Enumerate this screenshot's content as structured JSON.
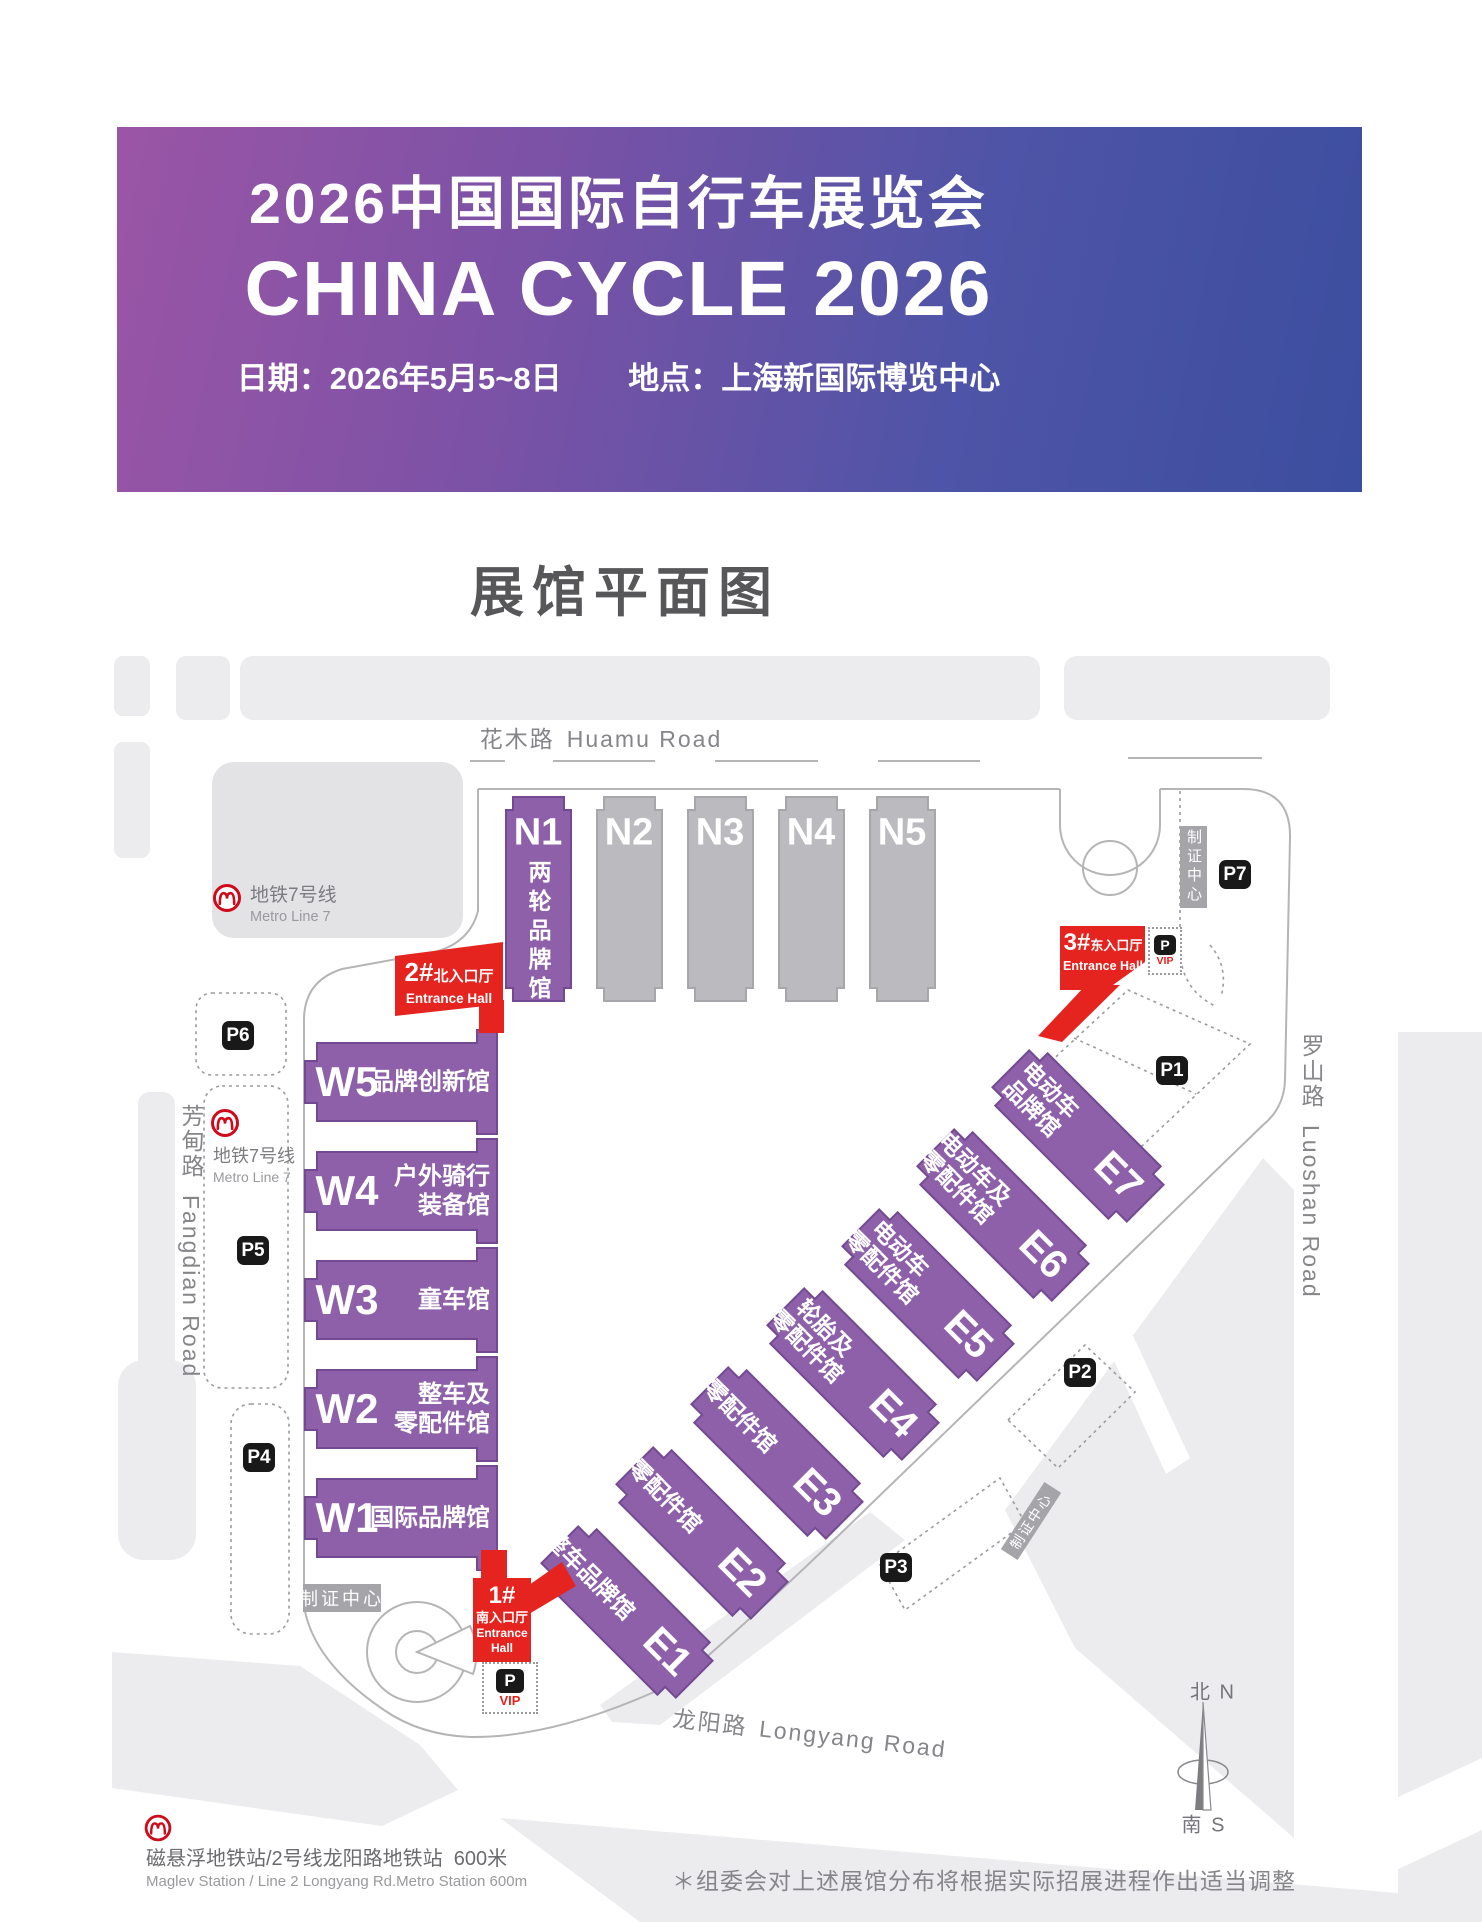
{
  "banner": {
    "title_cn": "2026中国国际自行车展览会",
    "title_en": "CHINA CYCLE 2026",
    "date": "日期：2026年5月5~8日",
    "venue": "地点：上海新国际博览中心"
  },
  "page_title": "展馆平面图",
  "map": {
    "roads": {
      "huamu_cn": "花木路",
      "huamu_en": "Huamu Road",
      "luoshan_cn": "罗山路",
      "luoshan_en": "Luoshan Road",
      "fangdian_cn": "芳甸路",
      "fangdian_en": "Fangdian Road",
      "longyang_cn": "龙阳路",
      "longyang_en": "Longyang Road"
    },
    "metro_line7_cn": "地铁7号线",
    "metro_line7_en": "Metro Line 7",
    "credential_center": "制证中心",
    "parking_label": "P",
    "vip_label": "VIP",
    "compass_north": "北 N",
    "compass_south": "南 S"
  },
  "halls": {
    "north": [
      {
        "id": "N1",
        "name": "两轮品牌馆"
      },
      {
        "id": "N2"
      },
      {
        "id": "N3"
      },
      {
        "id": "N4"
      },
      {
        "id": "N5"
      }
    ],
    "west": [
      {
        "id": "W5",
        "name_lines": [
          "品牌创新馆"
        ]
      },
      {
        "id": "W4",
        "name_lines": [
          "户外骑行",
          "装备馆"
        ]
      },
      {
        "id": "W3",
        "name_lines": [
          "童车馆"
        ]
      },
      {
        "id": "W2",
        "name_lines": [
          "整车及",
          "零配件馆"
        ]
      },
      {
        "id": "W1",
        "name_lines": [
          "国际品牌馆"
        ]
      }
    ],
    "east": [
      {
        "id": "E1",
        "name_lines": [
          "整车品牌馆"
        ]
      },
      {
        "id": "E2",
        "name_lines": [
          "零配件馆"
        ]
      },
      {
        "id": "E3",
        "name_lines": [
          "零配件馆"
        ]
      },
      {
        "id": "E4",
        "name_lines": [
          "轮胎及",
          "零配件馆"
        ]
      },
      {
        "id": "E5",
        "name_lines": [
          "电动车",
          "零配件馆"
        ]
      },
      {
        "id": "E6",
        "name_lines": [
          "电动车及",
          "零配件馆"
        ]
      },
      {
        "id": "E7",
        "name_lines": [
          "电动车",
          "品牌馆"
        ]
      }
    ]
  },
  "entrances": [
    {
      "num": "1#",
      "cn": "南入口厅",
      "en_lines": [
        "Entrance",
        "Hall"
      ]
    },
    {
      "num": "2#",
      "cn": "北入口厅",
      "en": "Entrance Hall"
    },
    {
      "num": "3#",
      "cn": "东入口厅",
      "en": "Entrance Hall"
    }
  ],
  "parking": {
    "p1": "P1",
    "p2": "P2",
    "p3": "P3",
    "p4": "P4",
    "p5": "P5",
    "p6": "P6",
    "p7": "P7"
  },
  "footer": {
    "metro_cn": "磁悬浮地铁站/2号线龙阳路地铁站  600米",
    "metro_en": "Maglev Station / Line 2 Longyang Rd.Metro Station 600m",
    "disclaimer": "＊组委会对上述展馆分布将根据实际招展进程作出适当调整"
  },
  "colors": {
    "accent_red": "#e5231f",
    "hall_purple": "#8d60a9",
    "hall_gray": "#bbbbbf",
    "banner_from": "#9b55a6",
    "banner_to": "#3c4e9f"
  }
}
